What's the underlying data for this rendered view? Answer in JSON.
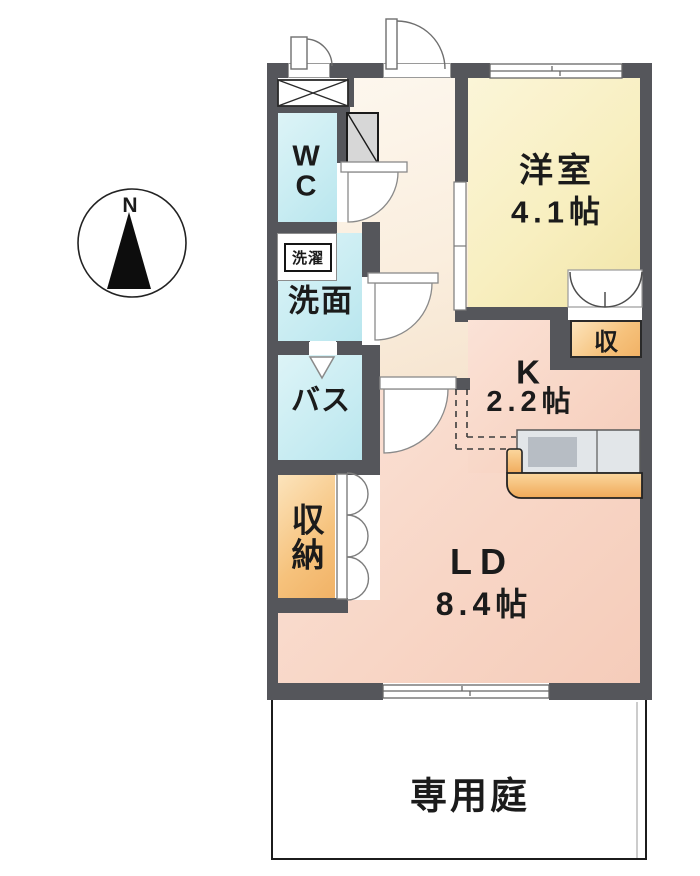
{
  "compass": {
    "north_label": "N"
  },
  "rooms": {
    "wc": {
      "label": "W\nC"
    },
    "laundry": {
      "label": "洗濯"
    },
    "washroom": {
      "label": "洗面"
    },
    "bath": {
      "label": "バス"
    },
    "storage": {
      "label": "収\n納"
    },
    "western_room": {
      "label": "洋室",
      "size": "4.1帖"
    },
    "kitchen": {
      "label": "K",
      "size": "2.2帖"
    },
    "living_dining": {
      "label": "LD",
      "size": "8.4帖"
    },
    "closet": {
      "label": "収"
    },
    "garden": {
      "label": "専用庭"
    }
  },
  "colors": {
    "wall": "#55565b",
    "water_room": "#c8ecf2",
    "western_room": "#f8efc0",
    "ldk": "#f8d6c6",
    "hallway": "#faeede",
    "storage_orange": "#f6c27c",
    "counter_gray": "#e2e6e9",
    "line": "#1b1b1b"
  }
}
